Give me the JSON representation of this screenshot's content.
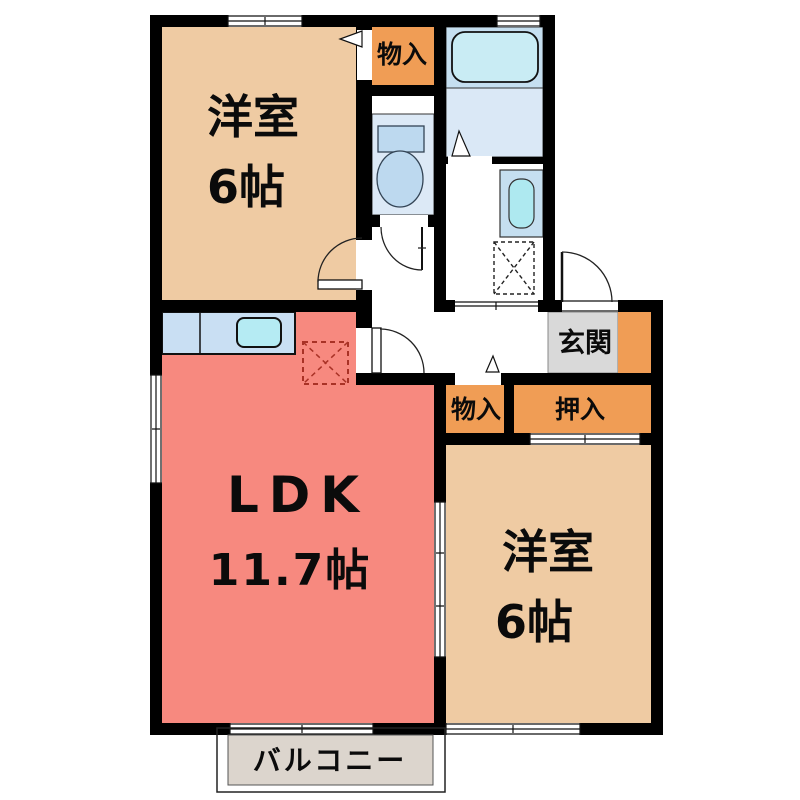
{
  "floorplan": {
    "rooms": {
      "bedroom_top": {
        "label": "洋室",
        "size": "6帖"
      },
      "ldk": {
        "label": "LDK",
        "size": "11.7帖"
      },
      "bedroom_bottom": {
        "label": "洋室",
        "size": "6帖"
      },
      "storage_top": {
        "label": "物入"
      },
      "storage_mid": {
        "label": "物入"
      },
      "closet": {
        "label": "押入"
      },
      "entrance": {
        "label": "玄関"
      },
      "balcony": {
        "label": "バルコニー"
      }
    },
    "colors": {
      "wall": "#000000",
      "room_beige": "#EFCBA3",
      "closet_orange": "#F09D55",
      "ldk_pink": "#F7897F",
      "kitchen_counter": "#C9DFF3",
      "sink": "#B5EBF3",
      "bath_zone": "#C5DFF0",
      "bath_floor": "#DAE8F6",
      "bathtub": "#C9ECF4",
      "toilet_floor": "#DCE9F6",
      "fixture_blue": "#BDD9EF",
      "basin": "#AEE9F0",
      "genkan_gray": "#D9D9D9",
      "balcony_gray": "#DCD5CD",
      "fridge_dash": "#A93226"
    }
  }
}
